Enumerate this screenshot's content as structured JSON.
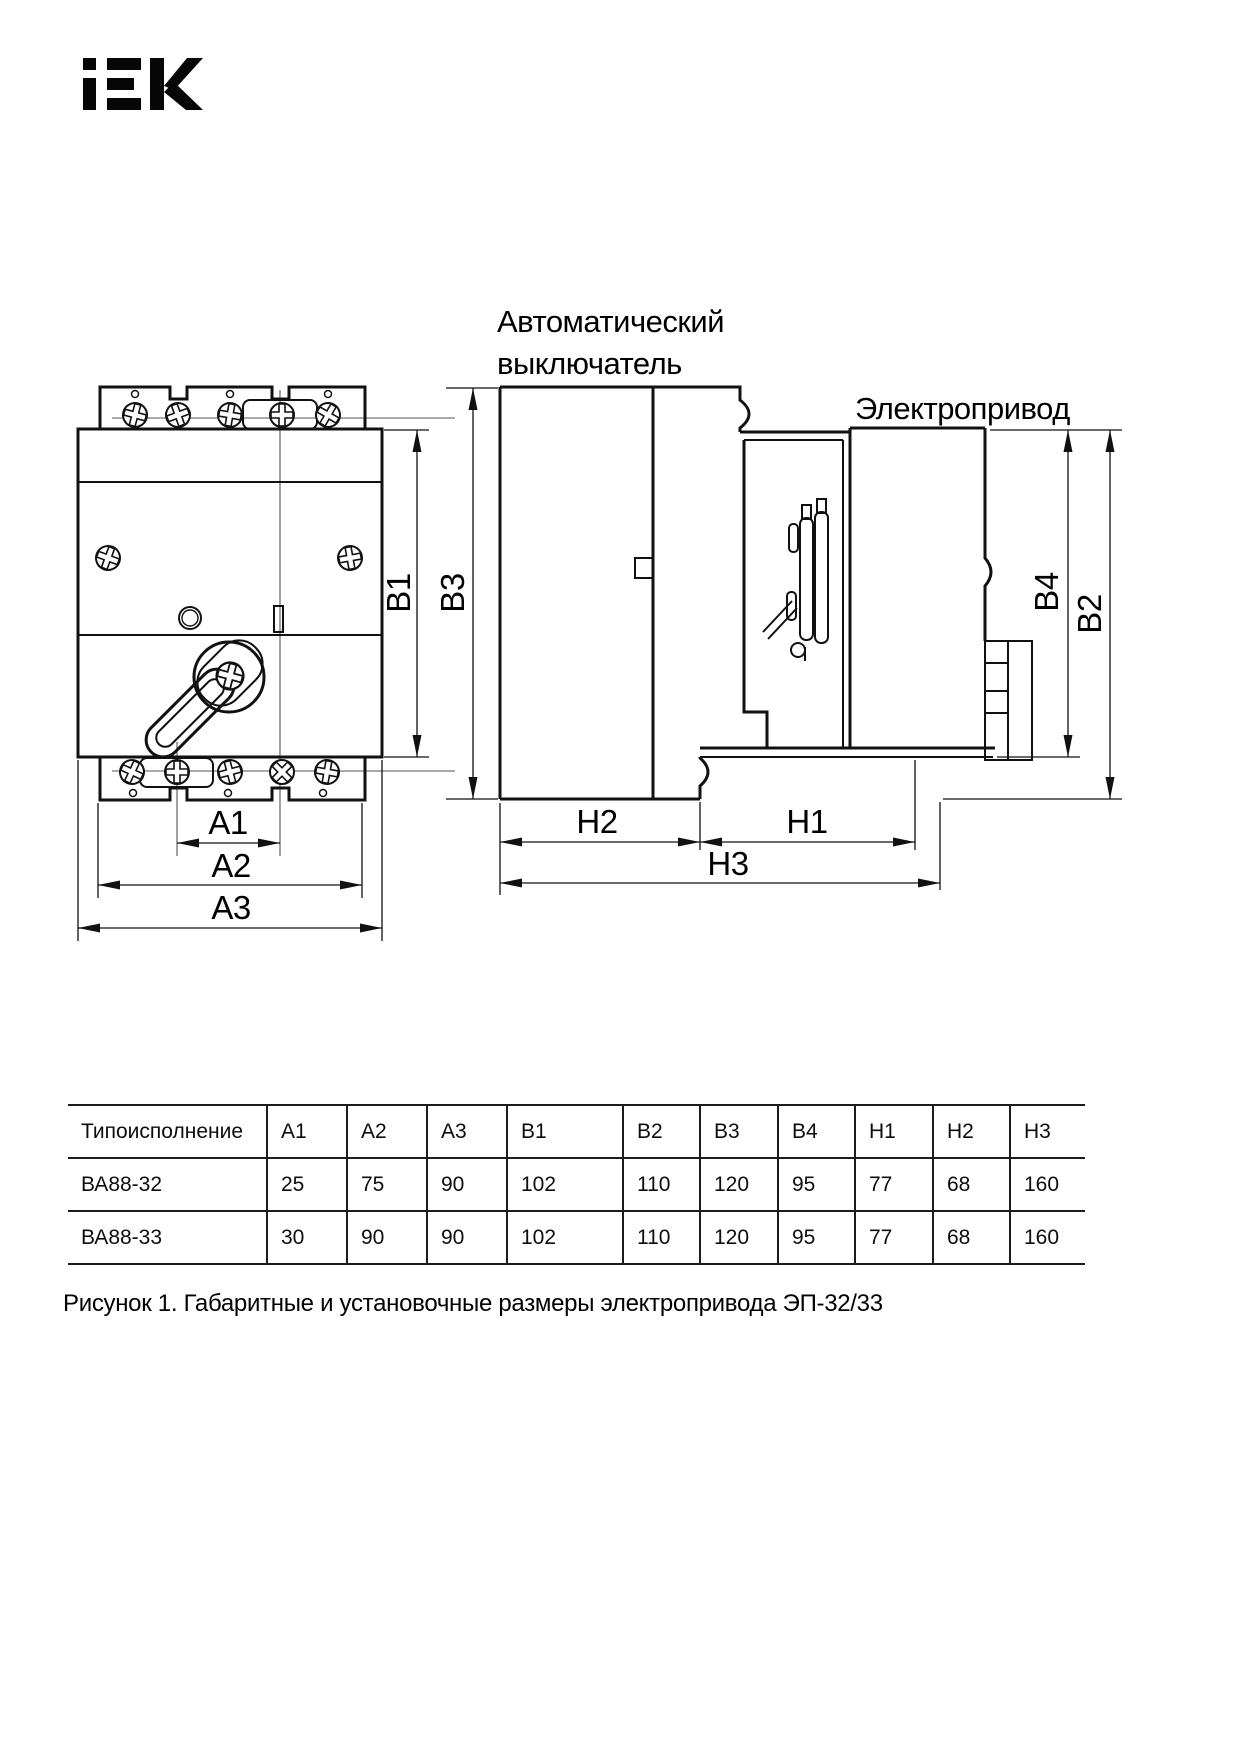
{
  "logo": {
    "brand": "IEK"
  },
  "drawing": {
    "labels": {
      "breaker_line1": "Автоматический",
      "breaker_line2": "выключатель",
      "drive": "Электропривод"
    },
    "dims": {
      "a1": "A1",
      "a2": "A2",
      "a3": "A3",
      "b1": "B1",
      "b2": "B2",
      "b3": "B3",
      "b4": "B4",
      "h1": "H1",
      "h2": "H2",
      "h3": "H3"
    }
  },
  "table": {
    "columns": [
      "Типоисполнение",
      "A1",
      "A2",
      "A3",
      "B1",
      "B2",
      "B3",
      "B4",
      "H1",
      "H2",
      "H3"
    ],
    "rows": [
      [
        "ВА88-32",
        "25",
        "75",
        "90",
        "102",
        "110",
        "120",
        "95",
        "77",
        "68",
        "160"
      ],
      [
        "ВА88-33",
        "30",
        "90",
        "90",
        "102",
        "110",
        "120",
        "95",
        "77",
        "68",
        "160"
      ]
    ]
  },
  "caption": "Рисунок 1. Габаритные и установочные размеры электропривода ЭП-32/33"
}
